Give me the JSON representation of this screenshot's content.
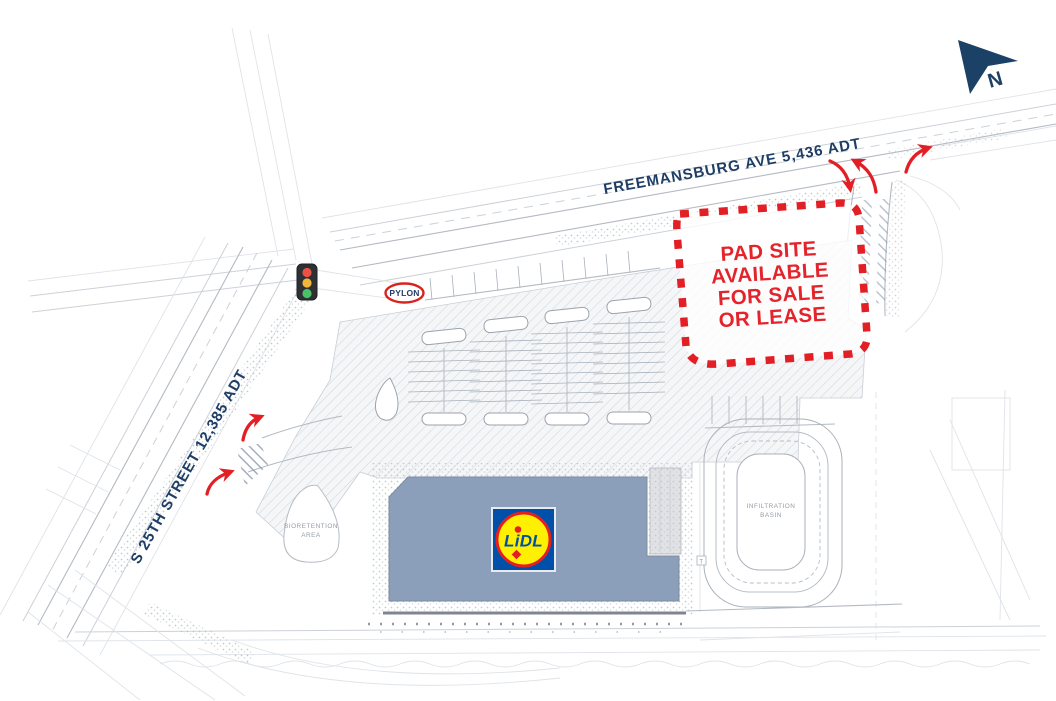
{
  "site_plan": {
    "north_indicator": "N",
    "streets": {
      "freemansburg_ave": "FREEMANSBURG AVE 5,436 ADT",
      "s_25th_street": "S 25TH STREET 12,385 ADT"
    },
    "pylon_badge": "PYLON",
    "pad_site_callout": {
      "lines": [
        "PAD SITE",
        "AVAILABLE",
        "FOR SALE",
        "OR LEASE"
      ]
    },
    "building_logo": "LiDL",
    "infiltration_basin": {
      "lines": [
        "INFILTRATION",
        "BASIN"
      ]
    },
    "bioretention_area": {
      "lines": [
        "BIORETENTION",
        "AREA"
      ]
    },
    "transformer_marker": "T",
    "colors": {
      "label_navy": "#1f3e66",
      "callout_red": "#e31f26",
      "building_fill": "#8c9fba",
      "lidl_blue": "#0050aa",
      "lidl_yellow": "#ffef00",
      "lidl_red": "#e3201f",
      "signal_red": "#ee5048",
      "signal_amber": "#f2b63a",
      "signal_green": "#49c268"
    }
  }
}
